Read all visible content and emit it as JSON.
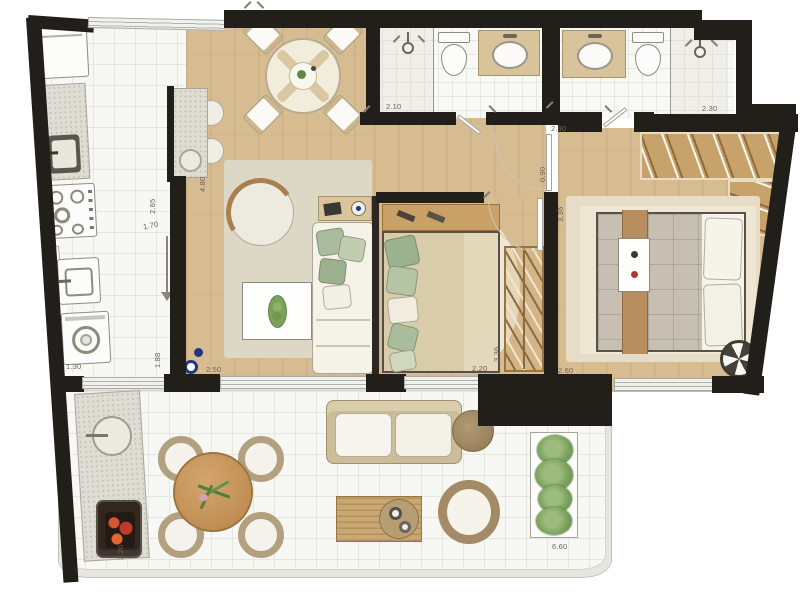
{
  "plan": {
    "type": "apartment-floor-plan",
    "dimensions": {
      "bath1_width": "2.10",
      "bath2_width": "2.30",
      "hall_width": "2.90",
      "hall_depth": "0.90",
      "master_width": "2.60",
      "master_depth": "3.36",
      "bedroom2_width": "2.20",
      "bedroom2_depth": "3.36",
      "living_width": "2.50",
      "living_length": "4.80",
      "kitchen_width": "1.70",
      "kitchen_length": "2.65",
      "service_width": "1.30",
      "service_length": "1.88",
      "balcony_depth": "2.20",
      "balcony_length": "6.60"
    },
    "colors": {
      "wall": "#221e1a",
      "wood_floor": "#d7bc92",
      "tile_floor": "#f7f7f3",
      "closet_wood": "#c7a26a",
      "pillow_green": "#a9bc9c",
      "accent_navy": "#23367e",
      "grill_coals": "#c0392b"
    }
  }
}
